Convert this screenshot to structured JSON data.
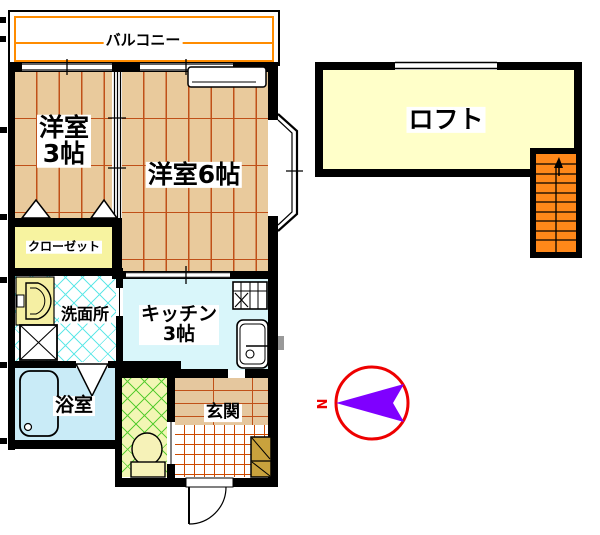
{
  "title": "1K apartment floor plan with loft",
  "rooms": {
    "balcony": {
      "label": "バルコニー"
    },
    "western3": {
      "name": "洋室",
      "size": "3帖"
    },
    "western6": {
      "label": "洋室6帖"
    },
    "closet": {
      "label": "クローゼット"
    },
    "washroom": {
      "label": "洗面所"
    },
    "kitchen": {
      "name": "キッチン",
      "size": "3帖"
    },
    "bathroom": {
      "label": "浴室"
    },
    "entrance": {
      "label": "玄関"
    },
    "loft": {
      "label": "ロフト"
    }
  },
  "compass": {
    "north_label": "N",
    "needle_points": "left"
  },
  "fixtures": [
    "air-conditioner",
    "washbasin",
    "washing-machine",
    "bathtub",
    "toilet",
    "gas-stove",
    "kitchen-sink",
    "shoe-cabinet",
    "loft-stairs",
    "entrance-door",
    "bay-window",
    "sliding-windows",
    "folding-doors"
  ],
  "colors": {
    "wall": "#000000",
    "wood_floor": "#E9CA9C",
    "wood_line": "#C05018",
    "balcony_line": "#FF8C00",
    "closet_fill": "#F7F3A0",
    "loft_fill": "#FFFFC9",
    "kitchen_fill": "#D9F6FA",
    "bathroom_fill": "#C9EBF7",
    "washroom_line": "#62E8E8",
    "toilet_fill": "#F2F6B4",
    "toilet_line": "#5ACC33",
    "entrance_tile_line": "#CC4A00",
    "stairs_fill": "#FF8819",
    "shoe_cabinet_fill": "#C9A23D",
    "compass_circle": "#EE0000",
    "compass_needle": "#7F00FF"
  }
}
